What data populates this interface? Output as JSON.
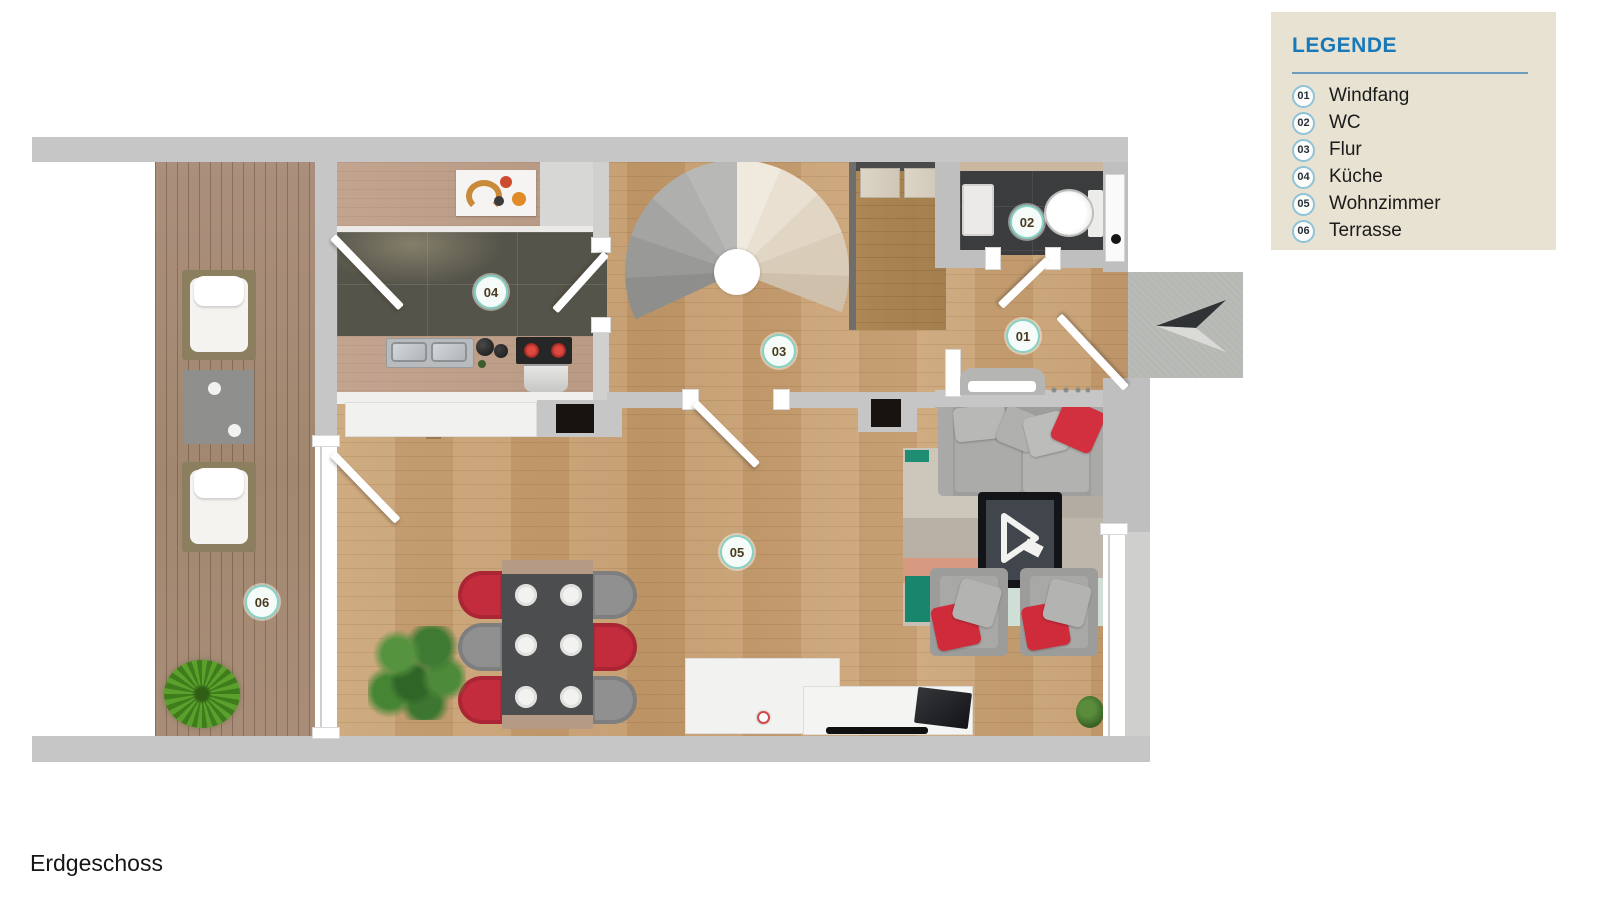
{
  "page": {
    "floor_label": "Erdgeschoss"
  },
  "legend": {
    "title": "LEGENDE",
    "items": [
      {
        "num": "01",
        "label": "Windfang"
      },
      {
        "num": "02",
        "label": "WC"
      },
      {
        "num": "03",
        "label": "Flur"
      },
      {
        "num": "04",
        "label": "Küche"
      },
      {
        "num": "05",
        "label": "Wohnzimmer"
      },
      {
        "num": "06",
        "label": "Terrasse"
      }
    ]
  },
  "floorplan": {
    "markers": [
      {
        "num": "01",
        "room": "Windfang"
      },
      {
        "num": "02",
        "room": "WC"
      },
      {
        "num": "03",
        "room": "Flur"
      },
      {
        "num": "04",
        "room": "Küche"
      },
      {
        "num": "05",
        "room": "Wohnzimmer"
      },
      {
        "num": "06",
        "room": "Terrasse"
      }
    ],
    "colors": {
      "legend_bg": "#e7e2d1",
      "legend_title_blue": "#1878b8",
      "marker_ring_teal": "#86d2c3",
      "wall_gray": "#c6c6c6",
      "wood_floor": "#c9a173",
      "terrace_wood": "#a88d7b",
      "kitchen_tile": "#55544a",
      "wc_tile": "#3b3c3e",
      "accent_red": "#d2303e",
      "rug_teal": "#1f8d74"
    }
  }
}
